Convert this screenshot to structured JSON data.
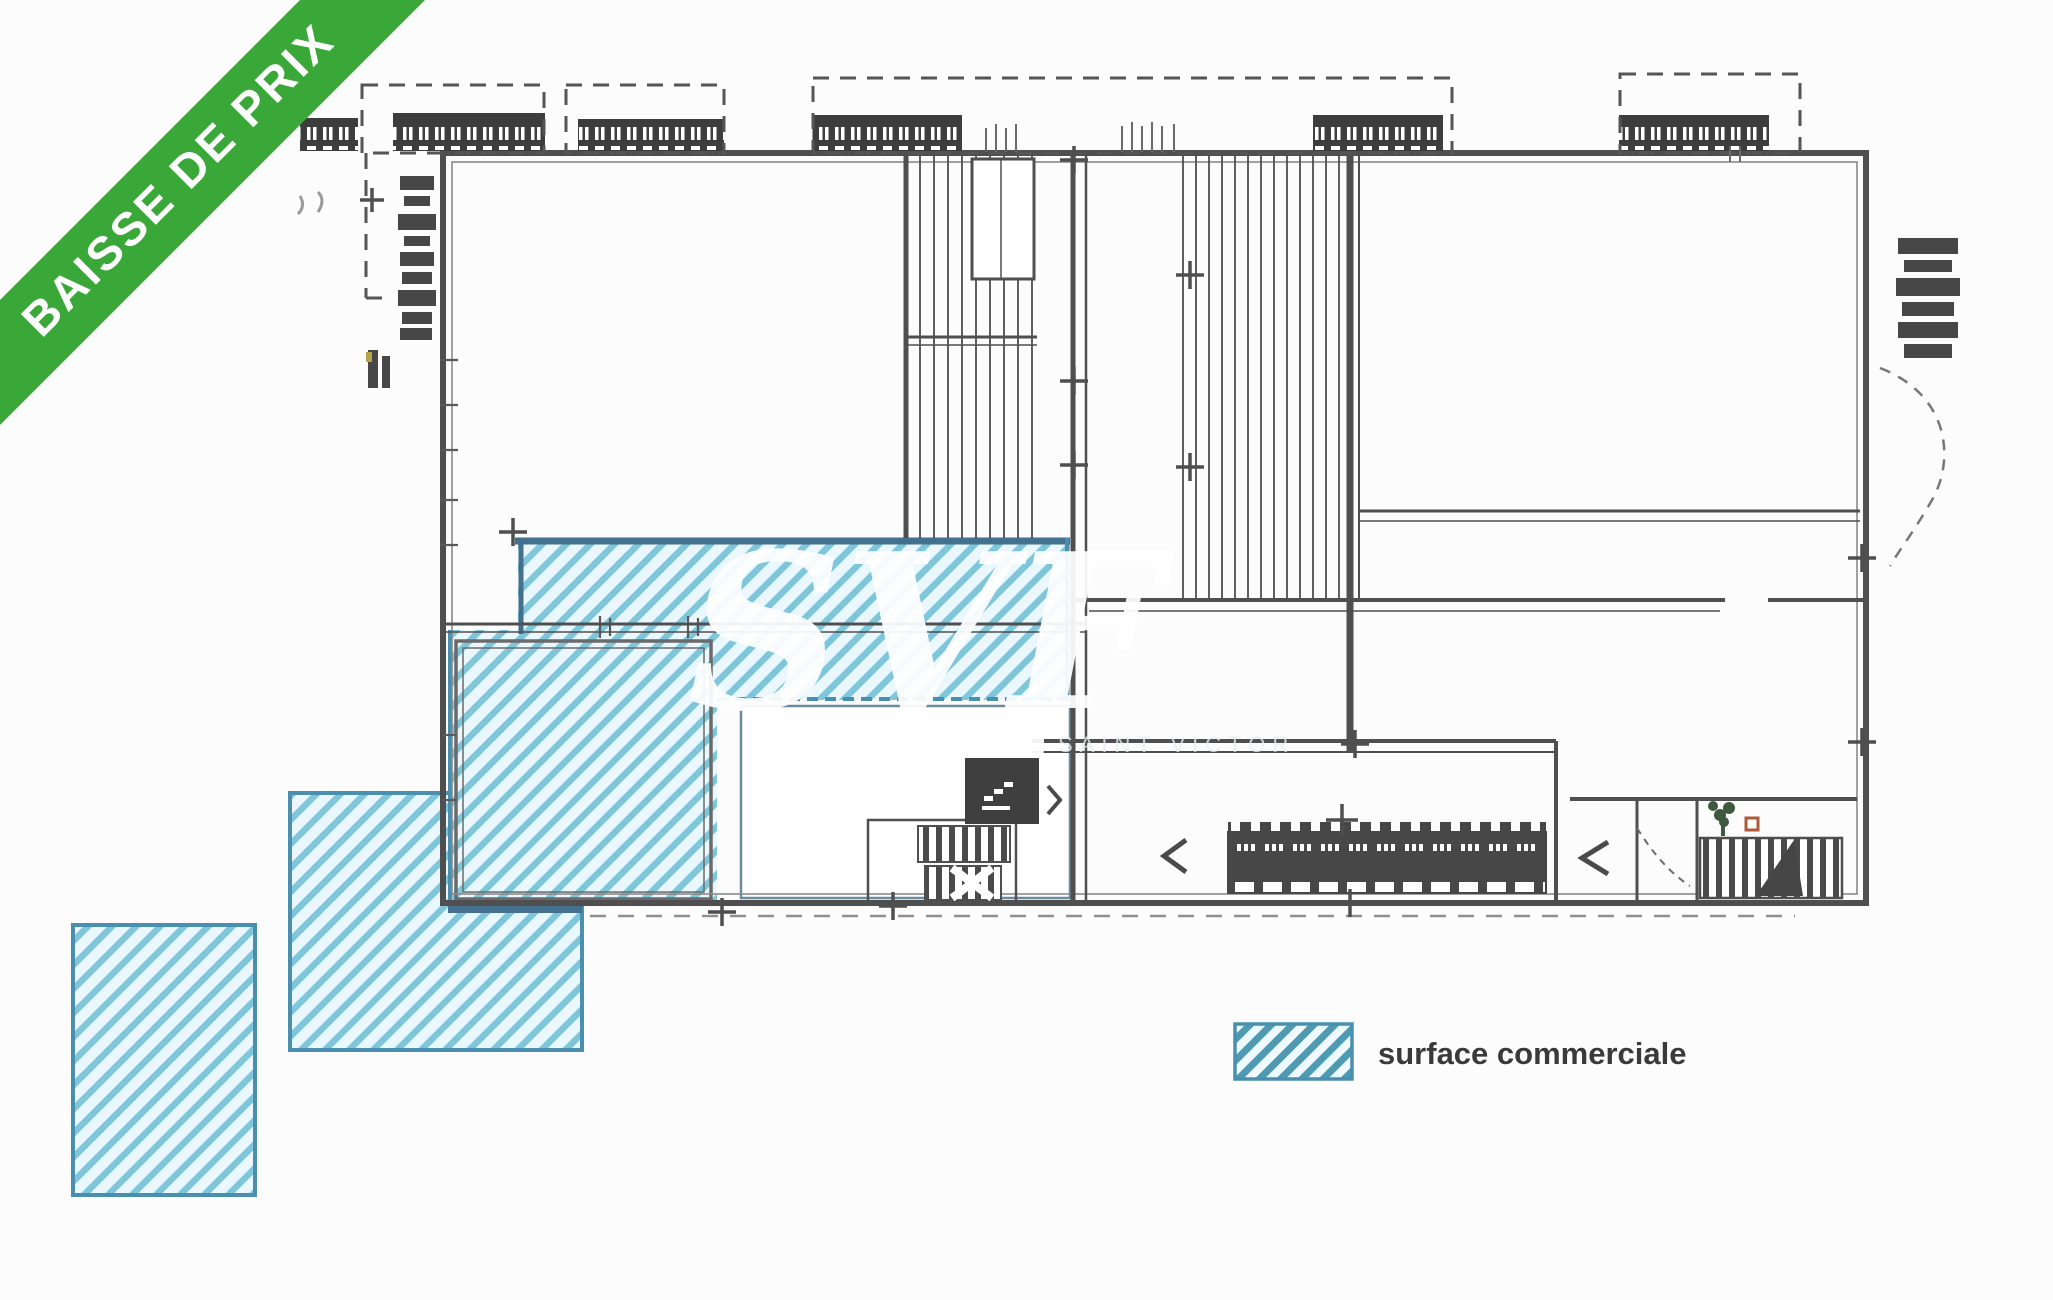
{
  "banner": {
    "label": "BAISSE DE PRIX",
    "background_color": "#3aa839",
    "text_color": "#ffffff"
  },
  "watermark": {
    "text": "SVF",
    "subtext": "SAINT VICTOR",
    "color": "#ffffff"
  },
  "legend": {
    "items": [
      {
        "label": "surface commerciale",
        "swatch_style": "diagonal-hatch",
        "swatch_stripe_color": "#4f9ab3",
        "swatch_bg_color": "#eefafd",
        "swatch_border_color": "#4a8fae"
      }
    ]
  },
  "plan": {
    "type": "floor-plan",
    "highlighted_area_meaning": "surface commerciale",
    "colors": {
      "wall": "#4f4f4f",
      "dock_block": "#3d3d3d",
      "hatch_stripe": "#7fc6da",
      "hatch_background": "#eaf7fc",
      "hatch_border": "#44708f",
      "hatch_border_light": "#4a8fae"
    }
  }
}
